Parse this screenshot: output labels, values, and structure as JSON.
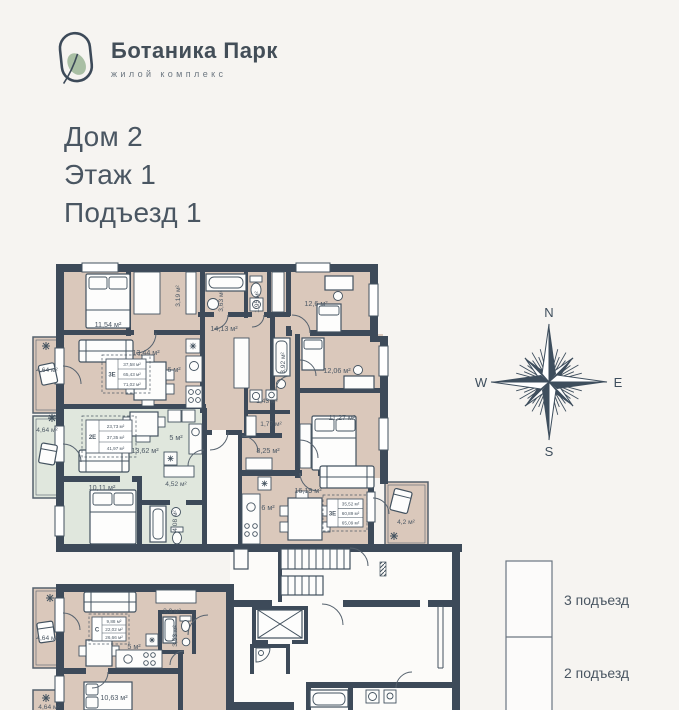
{
  "colors": {
    "wall": "#3d4a59",
    "beige": "#dac8bb",
    "green": "#e0e7dd",
    "bg": "#f6f4f1",
    "leaf": "#a9bfa4"
  },
  "logo": {
    "name": "Ботаника Парк",
    "tagline": "жилой комплекс"
  },
  "header": {
    "line1": "Дом 2",
    "line2": "Этаж 1",
    "line3": "Подъезд 1"
  },
  "compass": {
    "n": "N",
    "e": "E",
    "s": "S",
    "w": "W"
  },
  "entrances": {
    "top": "3 подъезд",
    "bottom": "2 подъезд"
  },
  "plan": {
    "labels": {
      "bedroom1": "11,54 м²",
      "closet1": "3,19 м²",
      "bath1": "3,63 м²",
      "wc1": "1,95 м²",
      "room_126": "12,6 м²",
      "hall1": "14,13 м²",
      "living1": "13,44 м²",
      "kitchen1": "6 м²",
      "balcony1": "4,64 м²",
      "bath2": "3,92 м²",
      "room_1206": "12,06 м²",
      "store_143": "1,43 м²",
      "store_177": "1,77 м²",
      "room_1127": "11,27 м²",
      "hall2": "8,25 м²",
      "balcony2": "4,64 м²",
      "living3": "13,62 м²",
      "kitchen3": "5 м²",
      "bedroom3": "10,11 м²",
      "hall3": "4,52 м²",
      "bath3": "4,08 м²",
      "living2": "16,19 м²",
      "kitchen2": "6 м²",
      "balcony42": "4,2 м²",
      "balcony4": "4,64 м²",
      "hall4": "3,9 м²",
      "kitchen4": "5 м²",
      "bath4": "3,53 м²",
      "room_1063": "10,63 м²",
      "balcony5": "4,64 м²"
    }
  },
  "apartments": [
    {
      "type": "3Е",
      "v1": "37,58 м²",
      "v2": "65,43 м²",
      "v3": "71,02 м²"
    },
    {
      "type": "2Е",
      "v1": "23,73 м²",
      "v2": "37,35 м²",
      "v3": "41,97 м²"
    },
    {
      "type": "3Е",
      "v1": "35,52 м²",
      "v2": "60,89 м²",
      "v3": "65,09 м²"
    },
    {
      "type": "С",
      "v1": "9,88 м²",
      "v2": "22,02 м²",
      "v3": "26,66 м²"
    }
  ]
}
